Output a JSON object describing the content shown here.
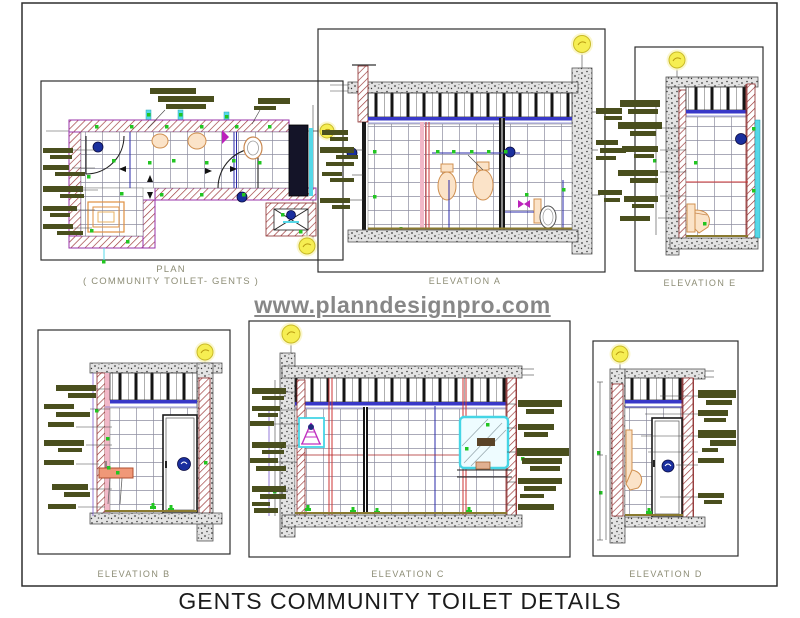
{
  "sheet": {
    "title": "GENTS COMMUNITY TOILET DETAILS",
    "watermark": "www.planndesignpro.com"
  },
  "panels": {
    "plan": {
      "label": "PLAN",
      "sublabel": "( COMMUNITY TOILET- GENTS )"
    },
    "elevation_a": {
      "label": "ELEVATION A"
    },
    "elevation_b": {
      "label": "ELEVATION B"
    },
    "elevation_c": {
      "label": "ELEVATION C"
    },
    "elevation_d": {
      "label": "ELEVATION D"
    },
    "elevation_e": {
      "label": "ELEVATION E"
    }
  },
  "colors": {
    "wall_hatch_red": "#993333",
    "annotation_olive": "#4a4f1e",
    "reference_yellow": "#f6ee52",
    "ceiling_line_blue": "#3838c8",
    "fixture_peach": "#fbe3c8",
    "basin_salmon": "#f09878",
    "signage_navy": "#1a2f9e",
    "accent_green": "#22c522",
    "accent_cyan": "#55d8e8",
    "accent_magenta": "#c030c0",
    "watermark_gray": "#878787"
  }
}
